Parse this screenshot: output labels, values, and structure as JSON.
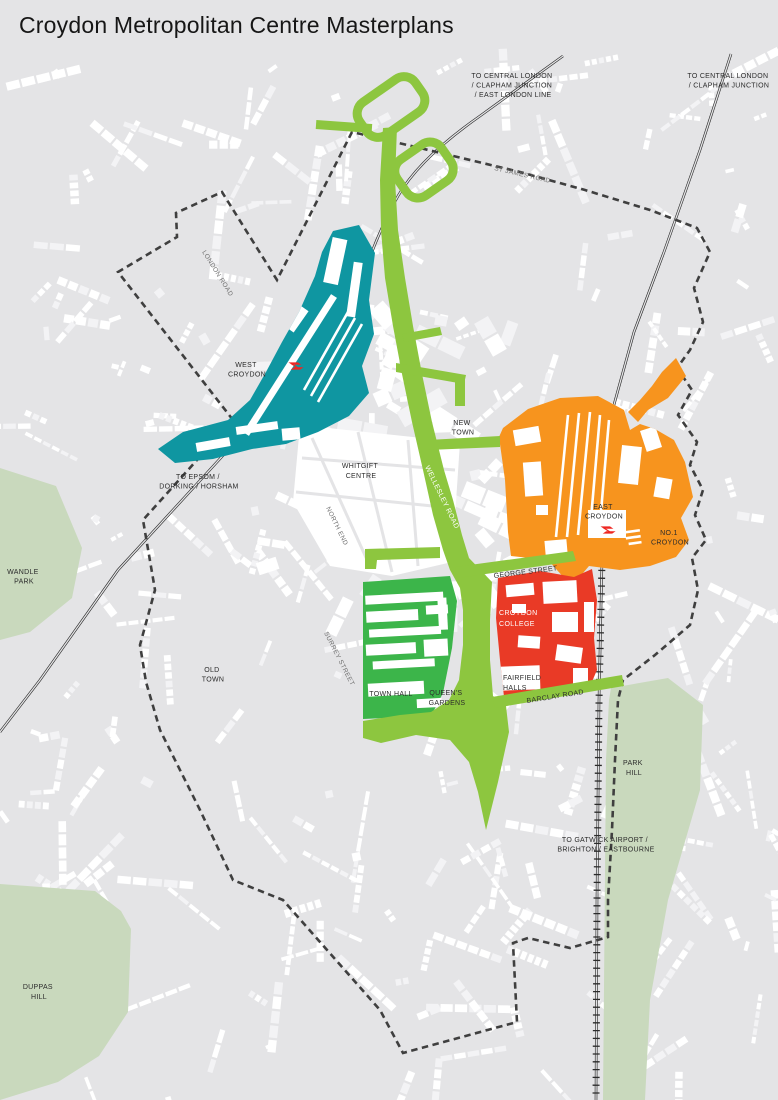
{
  "title": "Croydon Metropolitan Centre Masterplans",
  "labels": {
    "central_london_west": [
      "TO CENTRAL LONDON",
      "/ CLAPHAM JUNCTION",
      "/ EAST LONDON LINE"
    ],
    "central_london_east": [
      "TO CENTRAL LONDON",
      "/ CLAPHAM JUNCTION"
    ],
    "epsom": [
      "TO EPSOM /",
      "DORKING / HORSHAM"
    ],
    "gatwick": [
      "TO GATWICK AIRPORT /",
      "BRIGHTON / EASTBOURNE"
    ],
    "st_james_road": "ST JAMES ROAD",
    "london_road": "LONDON ROAD",
    "west_croydon": [
      "WEST",
      "CROYDON"
    ],
    "new_town": [
      "NEW",
      "TOWN"
    ],
    "whitgift_centre": [
      "WHITGIFT",
      "CENTRE"
    ],
    "wellesley_road": "WELLESLEY ROAD",
    "north_end": "NORTH END",
    "east_croydon": [
      "EAST",
      "CROYDON"
    ],
    "no1_croydon": [
      "NO.1",
      "CROYDON"
    ],
    "wandle_park": [
      "WANDLE",
      "PARK"
    ],
    "george_street": "GEORGE STREET",
    "croydon_college": [
      "CROYDON",
      "COLLEGE"
    ],
    "surrey_street": "SURREY STREET",
    "old_town": [
      "OLD",
      "TOWN"
    ],
    "town_hall": "TOWN HALL",
    "queens_gardens": [
      "QUEEN'S",
      "GARDENS"
    ],
    "fairfield_halls": [
      "FAIRFIELD",
      "HALLS"
    ],
    "barclay_road": "BARCLAY ROAD",
    "park_hill": [
      "PARK",
      "HILL"
    ],
    "duppas_hill": [
      "DUPPAS",
      "HILL"
    ]
  },
  "colors": {
    "background": "#e4e4e6",
    "building": "#ffffff",
    "park": "#c9d9bd",
    "west_croydon_area": "#0f96a1",
    "east_croydon_area": "#f7941e",
    "fairfield_area": "#e93a26",
    "mid_croydon_area": "#3cb54a",
    "public_realm": "#8dc63f",
    "boundary": "#3f3f3f",
    "railway": "#2b2b2b",
    "rail_icon": "#ee2722"
  }
}
